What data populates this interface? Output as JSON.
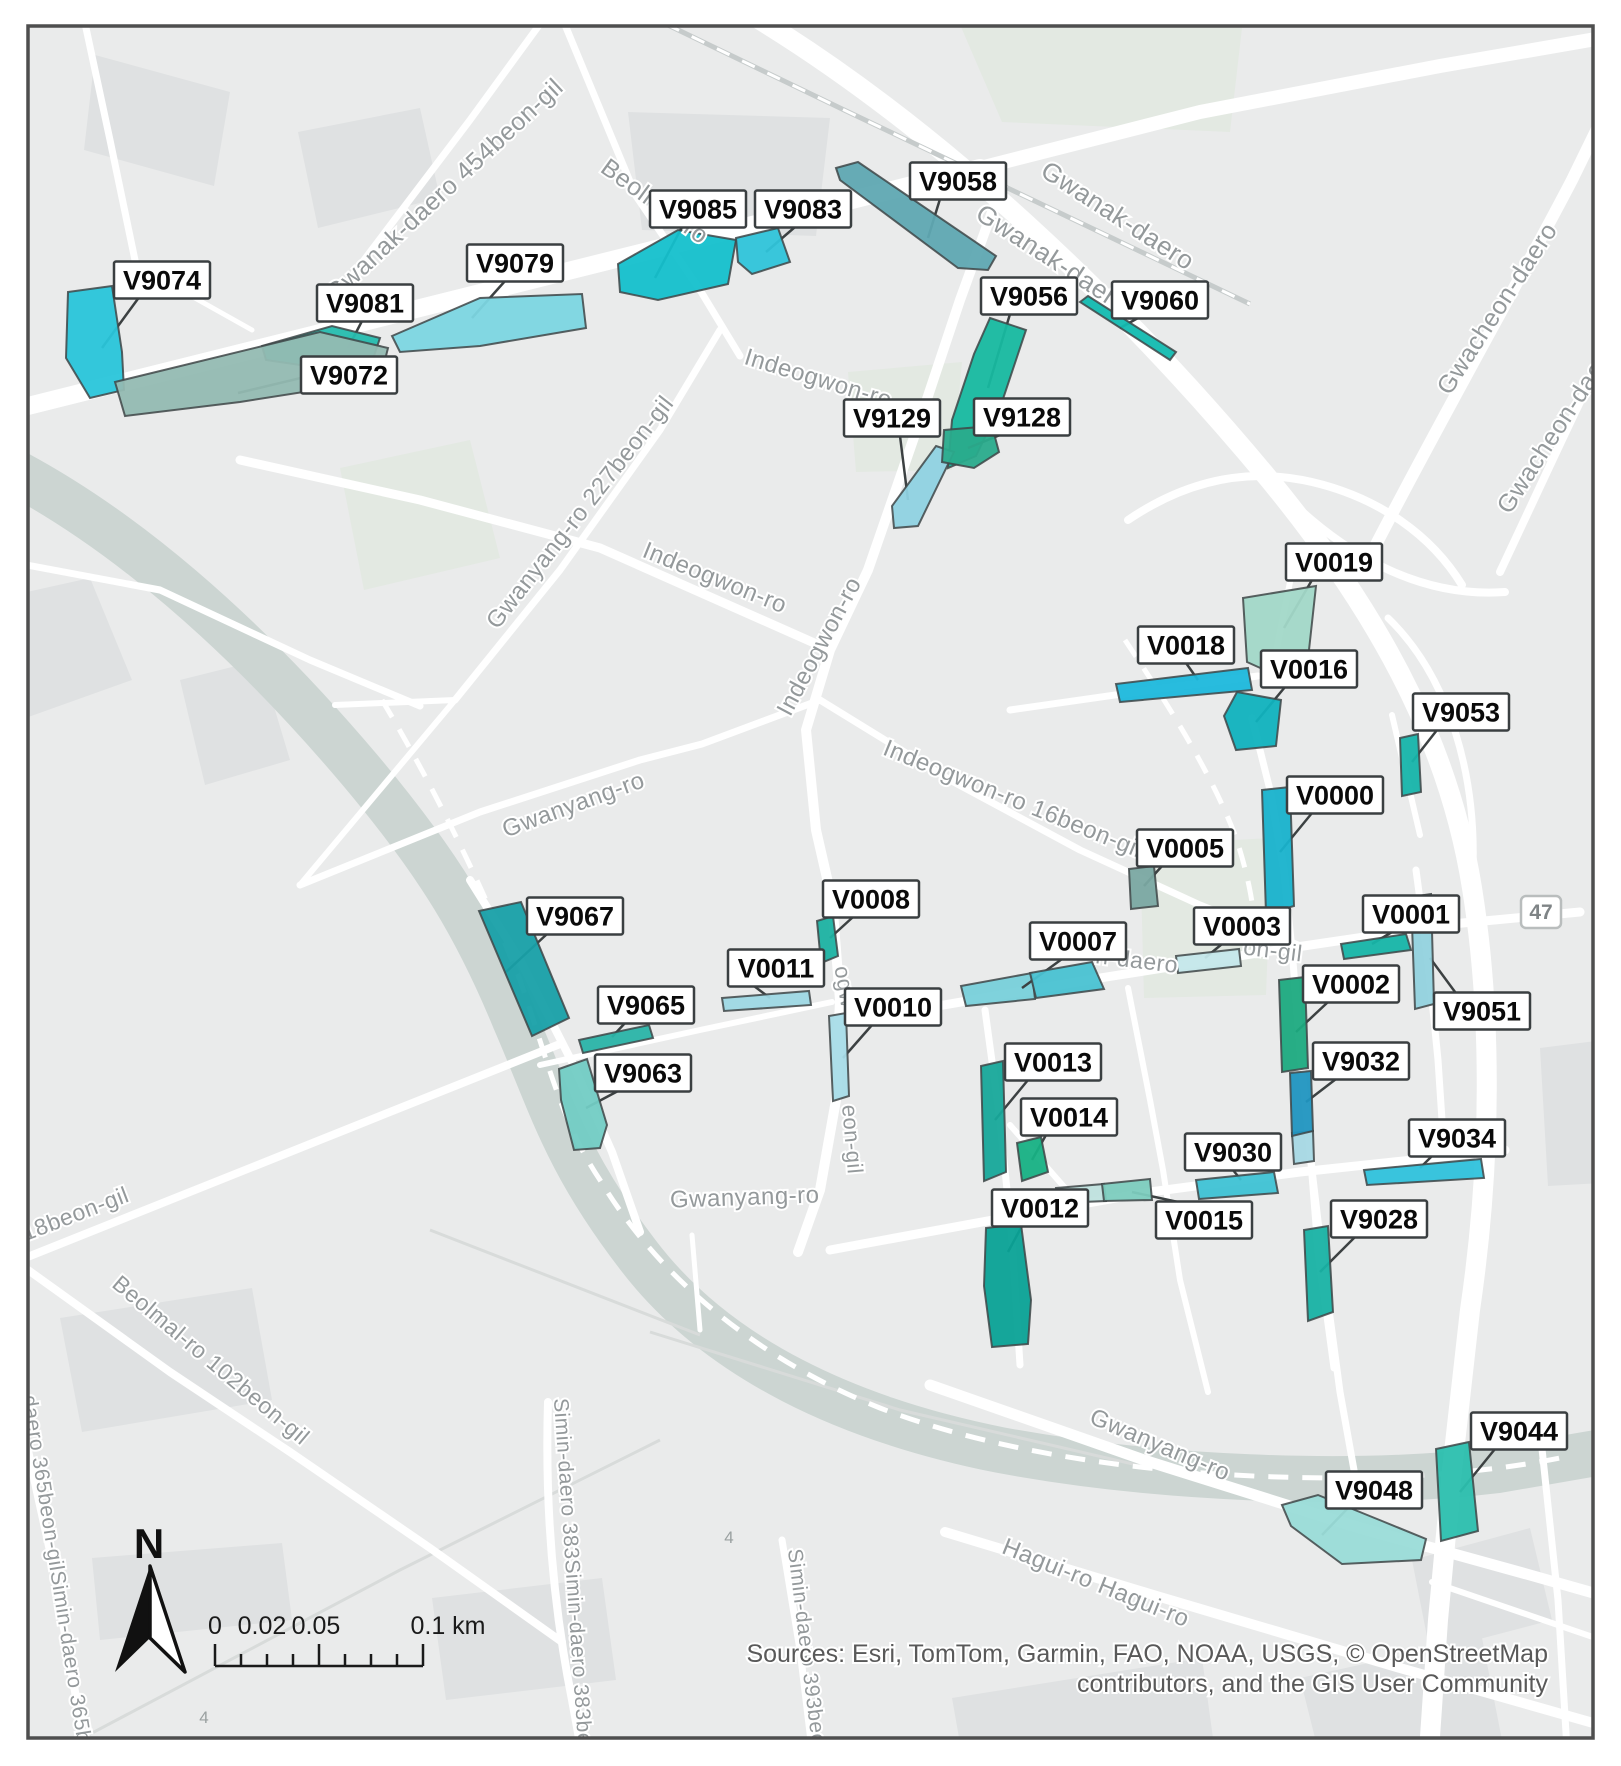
{
  "map": {
    "background_color": "#eaebeb",
    "zones": [
      {
        "id": "V9074",
        "color": "#29c5da",
        "label_x": 162,
        "label_y": 280,
        "points": "68,292 112,286 122,352 124,390 90,398 66,358",
        "leader": "140,296 102,348"
      },
      {
        "id": "V9081",
        "color": "#25bcae",
        "label_x": 365,
        "label_y": 303,
        "points": "262,346 332,326 380,338 372,362 300,365 266,360",
        "leader": "362,321 348,348"
      },
      {
        "id": "V9072",
        "color": "#93bab2",
        "label_x": 349,
        "label_y": 375,
        "points": "115,382 320,332 388,348 380,380 240,402 125,416",
        "leader": "305,377 238,393"
      },
      {
        "id": "V9079",
        "color": "#7cd6e2",
        "label_x": 515,
        "label_y": 263,
        "points": "392,336 480,298 582,294 586,328 480,346 400,352",
        "leader": "505,281 472,318"
      },
      {
        "id": "V9085",
        "color": "#14c0cc",
        "label_x": 698,
        "label_y": 209,
        "points": "618,264 678,230 736,240 728,284 658,300 620,292",
        "leader": "682,227 655,278"
      },
      {
        "id": "V9083",
        "color": "#2fc4da",
        "label_x": 803,
        "label_y": 209,
        "points": "736,238 778,228 790,262 752,274 738,262",
        "leader": "795,227 766,252"
      },
      {
        "id": "V9058",
        "color": "#5fa8b2",
        "label_x": 958,
        "label_y": 181,
        "points": "836,168 858,162 996,256 988,270 958,268 840,180",
        "leader": "940,199 928,238"
      },
      {
        "id": "V9056",
        "color": "#17b9a0",
        "label_x": 1029,
        "label_y": 296,
        "points": "990,318 1026,330 1002,402 976,456 948,468 952,420 974,354",
        "leader": "1010,314 988,388"
      },
      {
        "id": "V9060",
        "color": "#12bab0",
        "label_x": 1160,
        "label_y": 300,
        "points": "1080,302 1088,296 1176,352 1170,360",
        "leader": "1138,318 1120,328"
      },
      {
        "id": "V9129",
        "color": "#8fd2e2",
        "label_x": 892,
        "label_y": 418,
        "points": "936,446 954,452 918,526 894,528 892,506",
        "leader": "900,436 908,500"
      },
      {
        "id": "V9128",
        "color": "#2aab8c",
        "label_x": 1022,
        "label_y": 417,
        "points": "944,430 992,426 999,452 974,468 942,462",
        "leader": "1000,435 968,448"
      },
      {
        "id": "V0019",
        "color": "#a2d8c8",
        "label_x": 1334,
        "label_y": 562,
        "points": "1243,598 1316,586 1309,650 1278,676 1247,662",
        "leader": "1312,580 1284,628"
      },
      {
        "id": "V0018",
        "color": "#1cb8dc",
        "label_x": 1186,
        "label_y": 645,
        "points": "1116,684 1248,668 1252,690 1120,702",
        "leader": "1186,663 1198,680"
      },
      {
        "id": "V0016",
        "color": "#10b2be",
        "label_x": 1309,
        "label_y": 669,
        "points": "1237,692 1281,700 1276,746 1236,750 1224,716",
        "leader": "1285,687 1256,722"
      },
      {
        "id": "V9053",
        "color": "#16b4aa",
        "label_x": 1461,
        "label_y": 712,
        "points": "1400,738 1418,734 1421,792 1402,796",
        "leader": "1437,730 1412,762"
      },
      {
        "id": "V0000",
        "color": "#18b2cc",
        "label_x": 1335,
        "label_y": 795,
        "points": "1262,790 1290,787 1294,906 1266,914",
        "leader": "1312,813 1280,852"
      },
      {
        "id": "V0005",
        "color": "#7aa8a2",
        "label_x": 1185,
        "label_y": 848,
        "points": "1129,869 1154,866 1158,906 1131,909",
        "leader": "1162,866 1144,886"
      },
      {
        "id": "V0003",
        "color": "#c4e7ea",
        "label_x": 1242,
        "label_y": 926,
        "points": "1176,956 1239,949 1241,966 1178,973",
        "leader": "1222,944 1205,958"
      },
      {
        "id": "V0001",
        "color": "#16b5a8",
        "label_x": 1411,
        "label_y": 914,
        "points": "1341,944 1406,934 1411,950 1344,959",
        "leader": "1392,932 1372,944"
      },
      {
        "id": "V9051",
        "color": "#92d2de",
        "label_x": 1482,
        "label_y": 1011,
        "points": "1411,897 1431,894 1434,1004 1415,1009",
        "leader": "1458,996 1430,958"
      },
      {
        "id": "V0002",
        "color": "#1caa80",
        "label_x": 1351,
        "label_y": 984,
        "points": "1279,980 1305,977 1308,1068 1282,1072",
        "leader": "1328,1002 1296,1032"
      },
      {
        "id": "V0007",
        "color": "#49c2d2",
        "label_x": 1078,
        "label_y": 941,
        "points": "1030,973 1092,962 1104,989 1036,998",
        "leader": "1062,959 1022,988"
      },
      {
        "id": "V0008",
        "color": "#1cb2a2",
        "label_x": 871,
        "label_y": 899,
        "points": "817,921 833,916 838,956 821,963",
        "leader": "853,917 830,938"
      },
      {
        "id": "V0011",
        "color": "#9ed8e4",
        "label_x": 776,
        "label_y": 968,
        "points": "722,998 809,991 811,1005 724,1011",
        "leader": "754,986 770,998"
      },
      {
        "id": "V0010",
        "color": "#a8dce8",
        "label_x": 893,
        "label_y": 1007,
        "points": "829,1016 846,1013 849,1096 833,1101",
        "leader": "872,1025 843,1058"
      },
      {
        "id": "V9067",
        "color": "#18a0a8",
        "label_x": 575,
        "label_y": 916,
        "points": "479,911 521,902 569,1018 532,1036",
        "leader": "547,934 506,972"
      },
      {
        "id": "V9065",
        "color": "#2ab4a8",
        "label_x": 646,
        "label_y": 1005,
        "points": "579,1040 649,1025 653,1038 583,1053",
        "leader": "625,1023 612,1037"
      },
      {
        "id": "V9063",
        "color": "#72ccc4",
        "label_x": 643,
        "label_y": 1073,
        "points": "559,1069 587,1059 607,1125 600,1148 574,1150 561,1100",
        "leader": "618,1091 586,1108"
      },
      {
        "id": "V0013",
        "color": "#17a89a",
        "label_x": 1053,
        "label_y": 1062,
        "points": "981,1066 1003,1061 1006,1172 984,1181",
        "leader": "1028,1080 995,1120"
      },
      {
        "id": "V0014",
        "color": "#17b184",
        "label_x": 1069,
        "label_y": 1117,
        "points": "1017,1143 1041,1137 1048,1172 1022,1181",
        "leader": "1046,1135 1032,1160"
      },
      {
        "id": "V0012",
        "color": "#0aa296",
        "label_x": 1040,
        "label_y": 1208,
        "points": "986,1228 1021,1224 1031,1300 1028,1344 992,1347 984,1286",
        "leader": "1022,1226 1008,1252"
      },
      {
        "id": "V0015",
        "color": "#7cccbe",
        "label_x": 1204,
        "label_y": 1220,
        "points": "1102,1184 1150,1179 1152,1200 1104,1201",
        "leader": "1178,1202 1132,1192"
      },
      {
        "id": "V9030",
        "color": "#3ec2d4",
        "label_x": 1233,
        "label_y": 1152,
        "points": "1196,1180 1274,1172 1278,1193 1199,1199",
        "leader": "1233,1170 1241,1180"
      },
      {
        "id": "V9032",
        "color": "#2095c0",
        "label_x": 1361,
        "label_y": 1061,
        "points": "1290,1073 1311,1071 1313,1131 1292,1136",
        "leader": "1336,1079 1306,1102"
      },
      {
        "id": "V9034",
        "color": "#2fc2dc",
        "label_x": 1457,
        "label_y": 1138,
        "points": "1364,1170 1481,1159 1484,1178 1367,1185",
        "leader": "1432,1156 1420,1168"
      },
      {
        "id": "V9028",
        "color": "#18b2a4",
        "label_x": 1379,
        "label_y": 1219,
        "points": "1304,1230 1328,1226 1333,1312 1308,1321",
        "leader": "1355,1237 1320,1272"
      },
      {
        "id": "V9048",
        "color": "#9adcd8",
        "label_x": 1374,
        "label_y": 1490,
        "points": "1282,1505 1318,1495 1382,1521 1426,1539 1421,1560 1342,1564 1291,1526",
        "leader": "1348,1508 1322,1535"
      },
      {
        "id": "V9044",
        "color": "#2bbfae",
        "label_x": 1519,
        "label_y": 1431,
        "points": "1436,1449 1469,1442 1478,1531 1441,1541",
        "leader": "1495,1449 1460,1492"
      }
    ],
    "zone_fragments": [
      {
        "part_of": "V0007",
        "color": "#78d0da",
        "points": "961,986 1032,973 1035,999 966,1006"
      },
      {
        "part_of": "V0015",
        "color": "#bfe2de",
        "points": "1056,1188 1104,1184 1106,1201 1058,1203"
      },
      {
        "part_of": "V9032",
        "color": "#a6d8e4",
        "points": "1292,1133 1313,1131 1314,1161 1294,1164"
      }
    ],
    "street_labels": [
      {
        "text": "Gwanak-daero 454beon-gil",
        "x": 450,
        "y": 196,
        "rot": -43,
        "size": 25
      },
      {
        "text": "Beolmal-ro",
        "x": 650,
        "y": 208,
        "rot": 36,
        "size": 25
      },
      {
        "text": "Gwanak-daero",
        "x": 1113,
        "y": 223,
        "rot": 33,
        "size": 26
      },
      {
        "text": "Gwanak-daero",
        "x": 1048,
        "y": 266,
        "rot": 33,
        "size": 26
      },
      {
        "text": "Gwacheon-daero",
        "x": 1504,
        "y": 313,
        "rot": -57,
        "size": 25
      },
      {
        "text": "Gwacheon-daero",
        "x": 1564,
        "y": 432,
        "rot": -57,
        "size": 25
      },
      {
        "text": "Indeogwon-ro",
        "x": 816,
        "y": 386,
        "rot": 17,
        "size": 24
      },
      {
        "text": "Indeogwon-ro",
        "x": 712,
        "y": 585,
        "rot": 22,
        "size": 24
      },
      {
        "text": "Indeogwon-ro",
        "x": 826,
        "y": 650,
        "rot": -62,
        "size": 24
      },
      {
        "text": "Gwanyang-ro 227beon-gil",
        "x": 586,
        "y": 517,
        "rot": -52,
        "size": 24
      },
      {
        "text": "Gwanyang-ro",
        "x": 576,
        "y": 812,
        "rot": -20,
        "size": 24
      },
      {
        "text": "Indeogwon-ro 16beon-gil",
        "x": 1010,
        "y": 806,
        "rot": 22,
        "size": 24
      },
      {
        "text": "n-daero",
        "x": 1136,
        "y": 968,
        "rot": 7,
        "size": 23
      },
      {
        "text": "on-gil",
        "x": 1272,
        "y": 958,
        "rot": 7,
        "size": 23
      },
      {
        "text": "Gwanyang-ro",
        "x": 745,
        "y": 1205,
        "rot": -2,
        "size": 24
      },
      {
        "text": "18beon-gil",
        "x": 78,
        "y": 1221,
        "rot": -21,
        "size": 23
      },
      {
        "text": "Beolmal-ro 102beon-gil",
        "x": 206,
        "y": 1366,
        "rot": 40,
        "size": 23
      },
      {
        "text": "daero 365beon-gilSimin-daero 365b",
        "x": 50,
        "y": 1570,
        "rot": 81,
        "size": 21
      },
      {
        "text": "Simin-daero 383Simin-daero 383be",
        "x": 566,
        "y": 1572,
        "rot": 86,
        "size": 21
      },
      {
        "text": "Simin-daero 393beo",
        "x": 800,
        "y": 1648,
        "rot": 83,
        "size": 21
      },
      {
        "text": "Gwanyang-ro",
        "x": 1157,
        "y": 1452,
        "rot": 23,
        "size": 24
      },
      {
        "text": "Hagui-ro Hagui-ro",
        "x": 1093,
        "y": 1590,
        "rot": 22,
        "size": 24
      },
      {
        "text": "ogw",
        "x": 838,
        "y": 988,
        "rot": 80,
        "size": 22
      },
      {
        "text": "eon-gil",
        "x": 845,
        "y": 1140,
        "rot": 85,
        "size": 22
      }
    ],
    "route_markers": [
      {
        "text": "47",
        "x": 1541,
        "y": 912,
        "shield": true
      },
      {
        "text": "4",
        "x": 729,
        "y": 1543,
        "shield": false
      },
      {
        "text": "4",
        "x": 204,
        "y": 1723,
        "shield": false
      }
    ],
    "north_arrow": {
      "label": "N"
    },
    "scale_bar": {
      "tick_labels": [
        "0",
        "0.02",
        "0.05",
        "0.1 km"
      ]
    },
    "attribution": {
      "line1": "Sources: Esri, TomTom, Garmin, FAO, NOAA, USGS, © OpenStreetMap",
      "line2": "contributors, and the GIS User Community"
    }
  }
}
